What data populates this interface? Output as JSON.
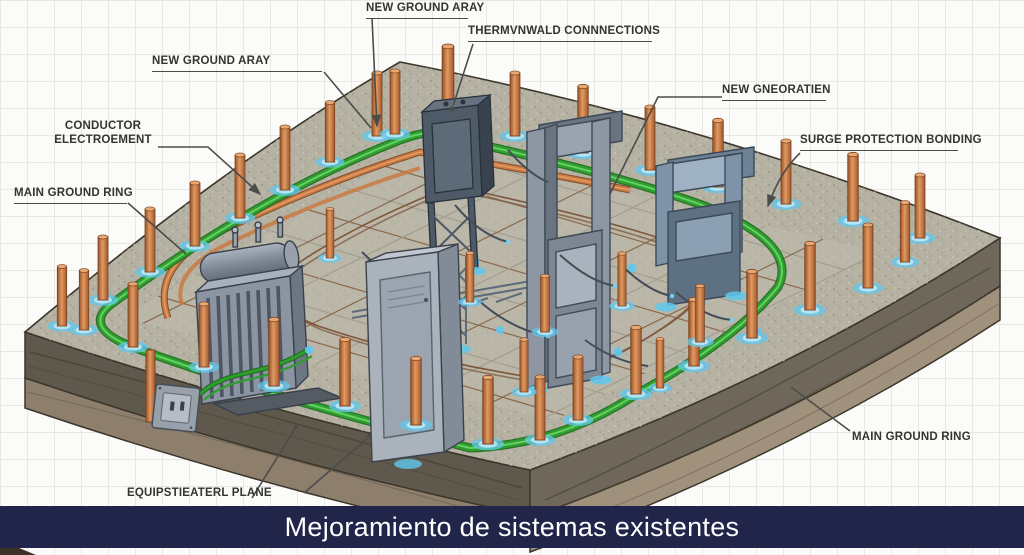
{
  "banner": {
    "text": "Mejoramiento de sistemas existentes"
  },
  "labels": {
    "top_ground_array": "NEW GROUND ARAY",
    "thermoweld_connections": "THERMVNWALD CONNNECTIONS",
    "left_ground_array": "NEW GROUND ARAY",
    "conductor_line1": "CONDUCTOR",
    "conductor_line2": "ELECTROEMENT",
    "main_ground_ring_left": "MAIN GROUND RING",
    "new_generation": "NEW GNEORATIEN",
    "surge_protection_bonding": "SURGE PROTECTION BONDING",
    "main_ground_ring_right": "MAIN GROUND RING",
    "equipotential_plane": "EQUIPSTIEATERL PLANE"
  },
  "colors": {
    "banner_bg": "#212549",
    "banner_fg": "#ffffff",
    "label_fg": "#343431",
    "leader_line": "#4c4c4a",
    "page_bg": "#fbfbf9",
    "grid_line": "#e7e7e3",
    "slab_top": "#b5b1a3",
    "soil_upper": "#6c6557",
    "soil_lower": "#9c8e7a",
    "copper_rod": "#c97a42",
    "ground_ring_green": "#2f9e2f",
    "glow_blue": "#5fc8ef",
    "steel_gray": "#8d99a6",
    "steel_dark": "#47525f"
  }
}
